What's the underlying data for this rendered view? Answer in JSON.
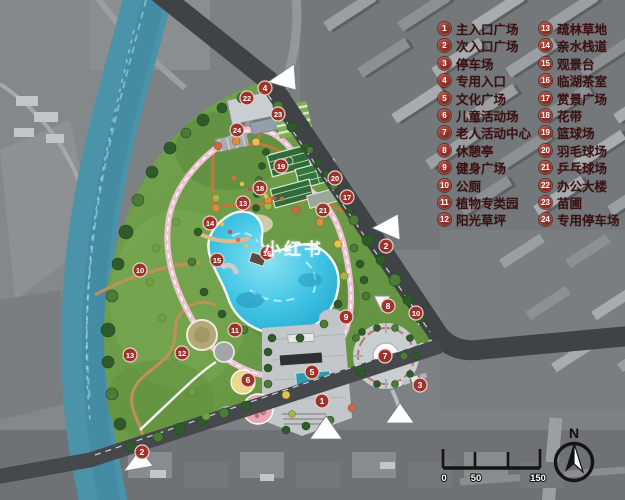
{
  "legend": {
    "items": [
      {
        "num": "1",
        "label": "主入口广场"
      },
      {
        "num": "2",
        "label": "次入口广场"
      },
      {
        "num": "3",
        "label": "停车场"
      },
      {
        "num": "4",
        "label": "专用入口"
      },
      {
        "num": "5",
        "label": "文化广场"
      },
      {
        "num": "6",
        "label": "儿童活动场"
      },
      {
        "num": "7",
        "label": "老人活动中心"
      },
      {
        "num": "8",
        "label": "休憩亭"
      },
      {
        "num": "9",
        "label": "健身广场"
      },
      {
        "num": "10",
        "label": "公厕"
      },
      {
        "num": "11",
        "label": "植物专类园"
      },
      {
        "num": "12",
        "label": "阳光草坪"
      },
      {
        "num": "13",
        "label": "疏林草地"
      },
      {
        "num": "14",
        "label": "亲水栈道"
      },
      {
        "num": "15",
        "label": "观景台"
      },
      {
        "num": "16",
        "label": "临湖茶室"
      },
      {
        "num": "17",
        "label": "赏景广场"
      },
      {
        "num": "18",
        "label": "花带"
      },
      {
        "num": "19",
        "label": "篮球场"
      },
      {
        "num": "20",
        "label": "羽毛球场"
      },
      {
        "num": "21",
        "label": "乒乓球场"
      },
      {
        "num": "22",
        "label": "办公大楼"
      },
      {
        "num": "23",
        "label": "苗圃"
      },
      {
        "num": "24",
        "label": "专用停车场"
      }
    ]
  },
  "map": {
    "watermark": "小红书",
    "markers": [
      {
        "n": "1",
        "x": 322,
        "y": 401
      },
      {
        "n": "2",
        "x": 386,
        "y": 246
      },
      {
        "n": "2",
        "x": 142,
        "y": 452
      },
      {
        "n": "3",
        "x": 420,
        "y": 385
      },
      {
        "n": "4",
        "x": 265,
        "y": 88
      },
      {
        "n": "5",
        "x": 312,
        "y": 372
      },
      {
        "n": "6",
        "x": 248,
        "y": 380
      },
      {
        "n": "7",
        "x": 385,
        "y": 356
      },
      {
        "n": "8",
        "x": 388,
        "y": 306
      },
      {
        "n": "9",
        "x": 346,
        "y": 317
      },
      {
        "n": "10",
        "x": 140,
        "y": 270
      },
      {
        "n": "10",
        "x": 416,
        "y": 313
      },
      {
        "n": "11",
        "x": 235,
        "y": 330
      },
      {
        "n": "12",
        "x": 182,
        "y": 353
      },
      {
        "n": "13",
        "x": 130,
        "y": 355
      },
      {
        "n": "13",
        "x": 243,
        "y": 203
      },
      {
        "n": "14",
        "x": 210,
        "y": 223
      },
      {
        "n": "15",
        "x": 217,
        "y": 260
      },
      {
        "n": "16",
        "x": 267,
        "y": 253
      },
      {
        "n": "17",
        "x": 347,
        "y": 197
      },
      {
        "n": "18",
        "x": 260,
        "y": 188
      },
      {
        "n": "19",
        "x": 281,
        "y": 166
      },
      {
        "n": "20",
        "x": 335,
        "y": 178
      },
      {
        "n": "21",
        "x": 323,
        "y": 210
      },
      {
        "n": "22",
        "x": 247,
        "y": 98
      },
      {
        "n": "23",
        "x": 278,
        "y": 114
      },
      {
        "n": "24",
        "x": 237,
        "y": 130
      }
    ]
  },
  "scalebar": {
    "labels": [
      "0",
      "50",
      "150"
    ]
  },
  "compass": {
    "north": "N"
  },
  "colors": {
    "park_green": "#6f9e4a",
    "lake_blue": "#3fc4e4",
    "river_teal": "#4b93a9",
    "road_dark": "#3f4346",
    "marker_red": "#9c342e",
    "path_pink": "#eec1d3",
    "path_orange": "#c8763a"
  }
}
